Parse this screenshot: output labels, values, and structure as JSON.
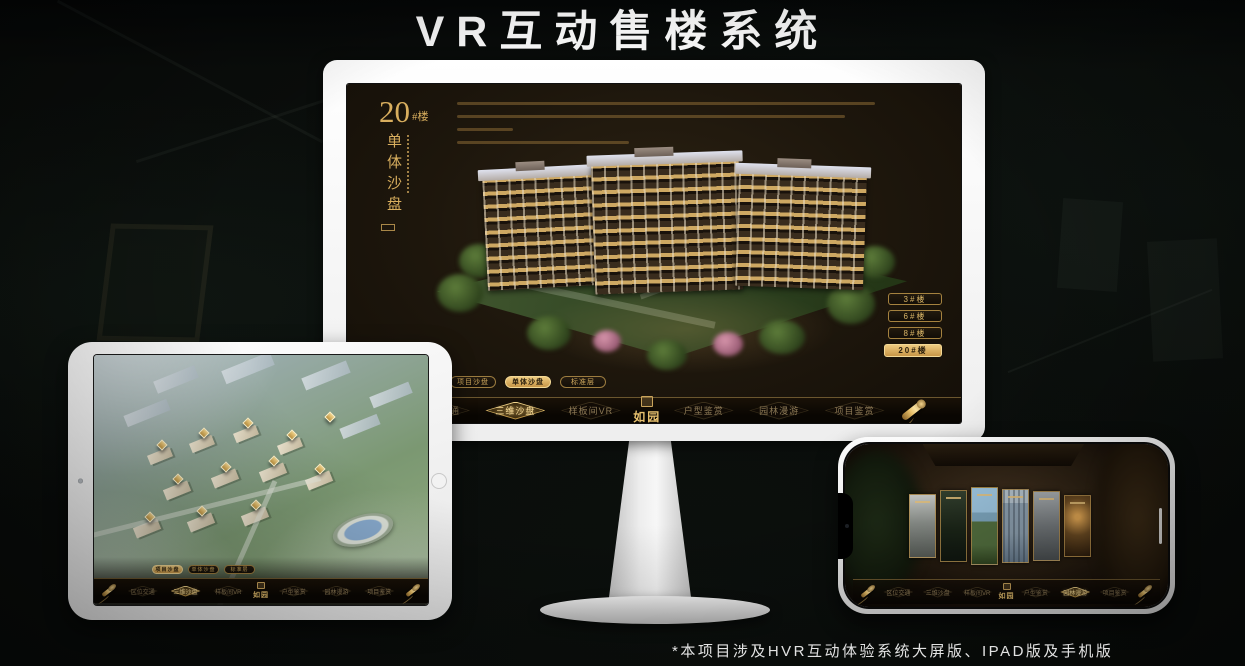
{
  "poster": {
    "title": "VR互动售楼系统",
    "footnote": "*本项目涉及HVR互动体验系统大屏版、IPAD版及手机版",
    "accent_gold": "#d2a856",
    "background": "#0a0d0b"
  },
  "screen": {
    "building_label": {
      "number": "20",
      "unit": "#楼",
      "subtitle": "单体沙盘"
    },
    "floor_buttons": [
      {
        "label": "3#楼",
        "active": false
      },
      {
        "label": "6#楼",
        "active": false
      },
      {
        "label": "8#楼",
        "active": false
      },
      {
        "label": "20#楼",
        "active": true
      }
    ],
    "sub_tabs": [
      {
        "label": "项目沙盘",
        "active": false
      },
      {
        "label": "单体沙盘",
        "active": true
      },
      {
        "label": "标准层",
        "active": false
      }
    ],
    "nav": {
      "logo": "如园",
      "items": [
        {
          "label": "区位交通",
          "active": false
        },
        {
          "label": "三维沙盘",
          "active": true
        },
        {
          "label": "样板间VR",
          "active": false
        },
        {
          "label": "户型鉴赏",
          "active": false
        },
        {
          "label": "园林漫游",
          "active": false
        },
        {
          "label": "项目鉴赏",
          "active": false
        }
      ]
    }
  },
  "ipad": {
    "sub_tabs": [
      {
        "label": "项目沙盘",
        "active": true
      },
      {
        "label": "单体沙盘",
        "active": false
      },
      {
        "label": "标准层",
        "active": false
      }
    ],
    "nav": {
      "logo": "如园",
      "items": [
        {
          "label": "区位交通",
          "active": false
        },
        {
          "label": "三维沙盘",
          "active": true
        },
        {
          "label": "样板间VR",
          "active": false
        },
        {
          "label": "户型鉴赏",
          "active": false
        },
        {
          "label": "园林漫游",
          "active": false
        },
        {
          "label": "项目鉴赏",
          "active": false
        }
      ]
    }
  },
  "phone": {
    "nav": {
      "logo": "如园",
      "items": [
        {
          "label": "区位交通",
          "active": false
        },
        {
          "label": "三维沙盘",
          "active": false
        },
        {
          "label": "样板间VR",
          "active": false
        },
        {
          "label": "户型鉴赏",
          "active": false
        },
        {
          "label": "园林漫游",
          "active": true
        },
        {
          "label": "项目鉴赏",
          "active": false
        }
      ]
    }
  }
}
